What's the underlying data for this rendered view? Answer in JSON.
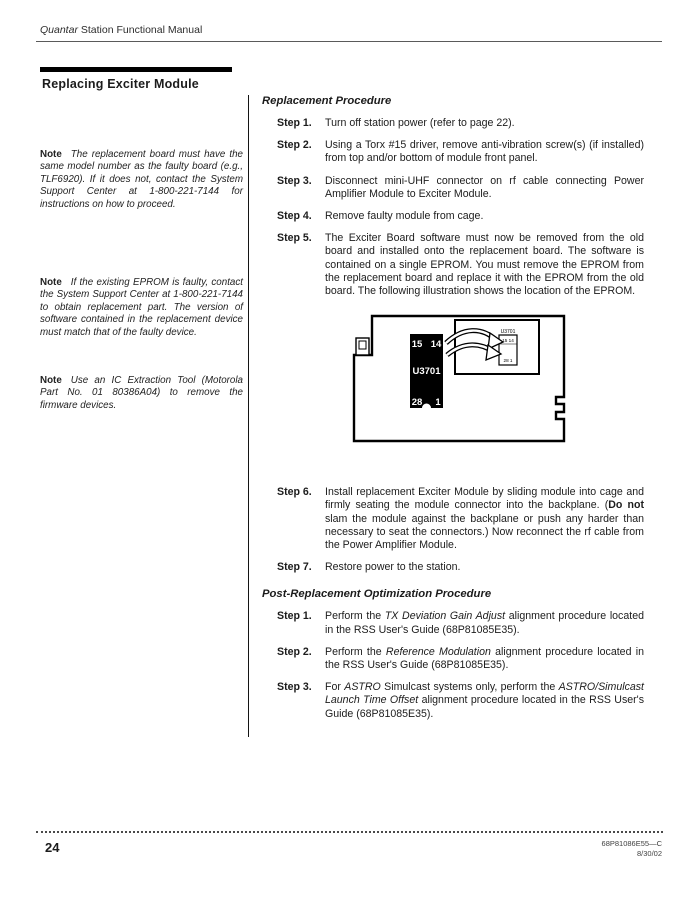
{
  "colors": {
    "ink": "#1c1c1c",
    "bar": "#000000",
    "rule": "#5a5a5a"
  },
  "header": {
    "title_italic": "Quantar",
    "title_rest": " Station Functional Manual"
  },
  "section_title": "Replacing Exciter Module",
  "notes": [
    {
      "label": "Note",
      "text": "The replacement board must have the same model number as the faulty board (e.g., TLF6920). If it does not, contact the System Support Center at 1-800-221-7144 for instructions on how to proceed."
    },
    {
      "label": "Note",
      "text": "If the existing EPROM is faulty, contact the System Support Center at 1-800-221-7144 to obtain replacement part. The version of software contained in the replacement device must match that of the faulty device."
    },
    {
      "label": "Note",
      "text": "Use an IC Extraction Tool (Motorola Part No. 01 80386A04) to remove the firmware devices."
    }
  ],
  "replacement": {
    "title": "Replacement Procedure",
    "steps_before_figure": [
      {
        "label": "Step 1.",
        "segments": [
          {
            "t": "Turn off station power (refer to page 22).",
            "s": "n"
          }
        ]
      },
      {
        "label": "Step 2.",
        "segments": [
          {
            "t": "Using a Torx #15 driver, remove anti-vibration screw(s) (if installed) from top and/or bottom of module front panel.",
            "s": "n"
          }
        ]
      },
      {
        "label": "Step 3.",
        "segments": [
          {
            "t": "Disconnect mini-UHF connector on rf cable connecting Power Amplifier Module to Exciter Module.",
            "s": "n"
          }
        ]
      },
      {
        "label": "Step 4.",
        "segments": [
          {
            "t": "Remove faulty module from cage.",
            "s": "n"
          }
        ]
      },
      {
        "label": "Step 5.",
        "segments": [
          {
            "t": "The Exciter Board software must now be removed from the old board and installed onto the replacement board. The software is contained on a single EPROM. You must remove the EPROM from the replacement board and replace it with the EPROM from the old board. The following illustration shows the location of the EPROM.",
            "s": "n"
          }
        ]
      }
    ],
    "steps_after_figure": [
      {
        "label": "Step 6.",
        "segments": [
          {
            "t": "Install replacement Exciter Module by sliding module into cage and firmly seating the module connector into the backplane. (",
            "s": "n"
          },
          {
            "t": "Do not",
            "s": "b"
          },
          {
            "t": " slam the module against the backplane or push any harder than necessary to seat the connectors.) Now reconnect the rf cable from the Power Amplifier Module.",
            "s": "n"
          }
        ]
      },
      {
        "label": "Step 7.",
        "segments": [
          {
            "t": "Restore power to the station.",
            "s": "n"
          }
        ]
      }
    ]
  },
  "post": {
    "title": "Post-Replacement Optimization Procedure",
    "steps": [
      {
        "label": "Step 1.",
        "segments": [
          {
            "t": "Perform the ",
            "s": "n"
          },
          {
            "t": "TX Deviation Gain Adjust",
            "s": "i"
          },
          {
            "t": "  alignment procedure located in the RSS User's Guide (68P81085E35).",
            "s": "n"
          }
        ]
      },
      {
        "label": "Step 2.",
        "segments": [
          {
            "t": "Perform the ",
            "s": "n"
          },
          {
            "t": "Reference Modulation",
            "s": "i"
          },
          {
            "t": " alignment procedure located in the RSS User's Guide (68P81085E35).",
            "s": "n"
          }
        ]
      },
      {
        "label": "Step 3.",
        "segments": [
          {
            "t": "For ",
            "s": "n"
          },
          {
            "t": "ASTRO",
            "s": "i"
          },
          {
            "t": " Simulcast systems only, perform the ",
            "s": "n"
          },
          {
            "t": "ASTRO/Simulcast Launch Time Offset",
            "s": "i"
          },
          {
            "t": " alignment procedure located in the RSS User's Guide (68P81085E35).",
            "s": "n"
          }
        ]
      }
    ]
  },
  "figure": {
    "chip": {
      "ref": "U3701",
      "pin_tl": "15",
      "pin_tr": "14",
      "pin_bl": "28",
      "pin_br": "1"
    },
    "inset": {
      "ref": "U3701",
      "pins_top": "15 14",
      "pins_bottom": "28  1"
    }
  },
  "footer": {
    "page_number": "24",
    "doc_number": "68P81086E55—C",
    "doc_date": "8/30/02"
  }
}
